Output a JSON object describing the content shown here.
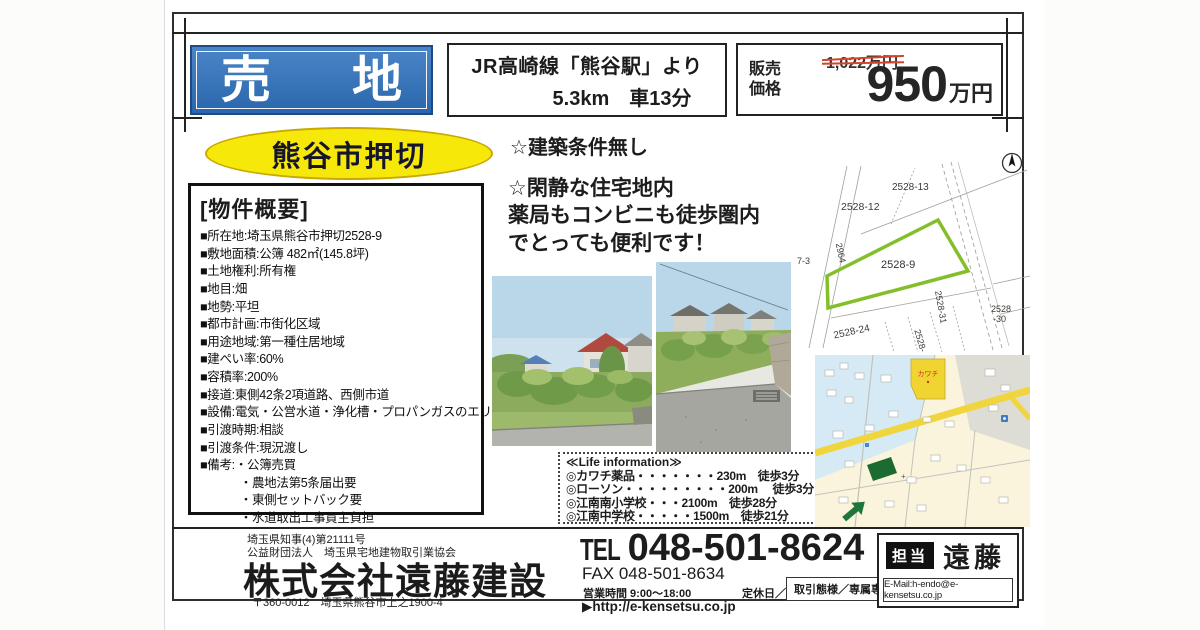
{
  "header": {
    "sale_left": "売",
    "sale_right": "地",
    "access_line1": "JR高崎線「熊谷駅」より",
    "access_line2": "5.3km　車13分",
    "price_label_line1": "販売",
    "price_label_line2": "価格",
    "price_old": "1,022万円",
    "price_value": "950",
    "price_unit": "万円"
  },
  "location_badge": "熊谷市押切",
  "notes": {
    "note1": "☆建築条件無し",
    "note2_line1": "☆閑静な住宅地内",
    "note2_line2": "薬局もコンビニも徒歩圏内",
    "note2_line3": "でとっても便利です！"
  },
  "overview": {
    "title": "[物件概要]",
    "items": [
      "■所在地:埼玉県熊谷市押切2528-9",
      "■敷地面積:公簿 482㎡(145.8坪)",
      "■土地権利:所有権",
      "■地目:畑",
      "■地勢:平坦",
      "■都市計画:市街化区域",
      "■用途地域:第一種住居地域",
      "■建ぺい率:60%",
      "■容積率:200%",
      "■接道:東側42条2項道路、西側市道",
      "■設備:電気・公営水道・浄化槽・プロパンガスのエリア",
      "■引渡時期:相談",
      "■引渡条件:現況渡し",
      "■備考:・公簿売買",
      "　　　 ・農地法第5条届出要",
      "　　　 ・東側セットバック要",
      "　　　 ・水道取出工事買主負担"
    ]
  },
  "life_info": {
    "title": "≪Life  information≫",
    "items": [
      "◎カワチ薬品・・・・・・・230m　徒歩3分",
      "◎ローソン・・・・・・・・・200m　 徒歩3分",
      "◎江南南小学校・・・2100m　徒歩28分",
      "◎江南中学校・・・・・1500m　徒歩21分"
    ]
  },
  "plat_map": {
    "labels": {
      "p13": "2528-13",
      "p12": "2528-12",
      "p9": "2528-9",
      "p24": "2528-24",
      "p28": "2528-",
      "p31": "2528-31",
      "p30a": "2528",
      "p30b": "-30",
      "p2964": "2964",
      "p73": "7-3"
    }
  },
  "street_map": {
    "store": "カワチ"
  },
  "footer": {
    "license1": "埼玉県知事(4)第21111号",
    "license2": "公益財団法人　埼玉県宅地建物取引業協会",
    "company": "株式会社遠藤建設",
    "address": "〒360-0012　埼玉県熊谷市上之1900-4",
    "tel_label": "TEL",
    "tel_number": "048-501-8624",
    "fax": "FAX 048-501-8634",
    "hours": "営業時間 9:00～18:00",
    "holiday": "定休日／日・祝",
    "url": "▶http://e-kensetsu.co.jp",
    "deal_type": "取引態様／専属専任",
    "staff_label": "担当",
    "staff_name": "遠藤",
    "email": "E-Mail:h-endo@e-kensetsu.co.jp"
  }
}
